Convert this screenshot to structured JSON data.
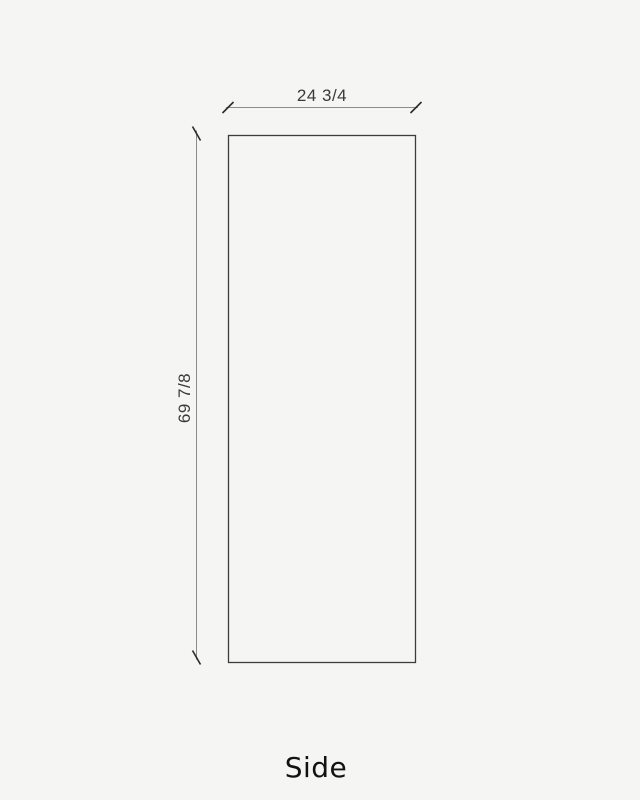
{
  "drawing": {
    "view_label": "Side",
    "dimensions": {
      "width": "24 3/4",
      "height": "69 7/8"
    }
  },
  "colors": {
    "background": "#f5f5f3",
    "panel_outline": "#3c3c3c",
    "dimension_line": "#8c8c8c",
    "tick_mark": "#2b2b2b",
    "dimension_text": "#3a3a3a",
    "title_text": "#121212"
  }
}
